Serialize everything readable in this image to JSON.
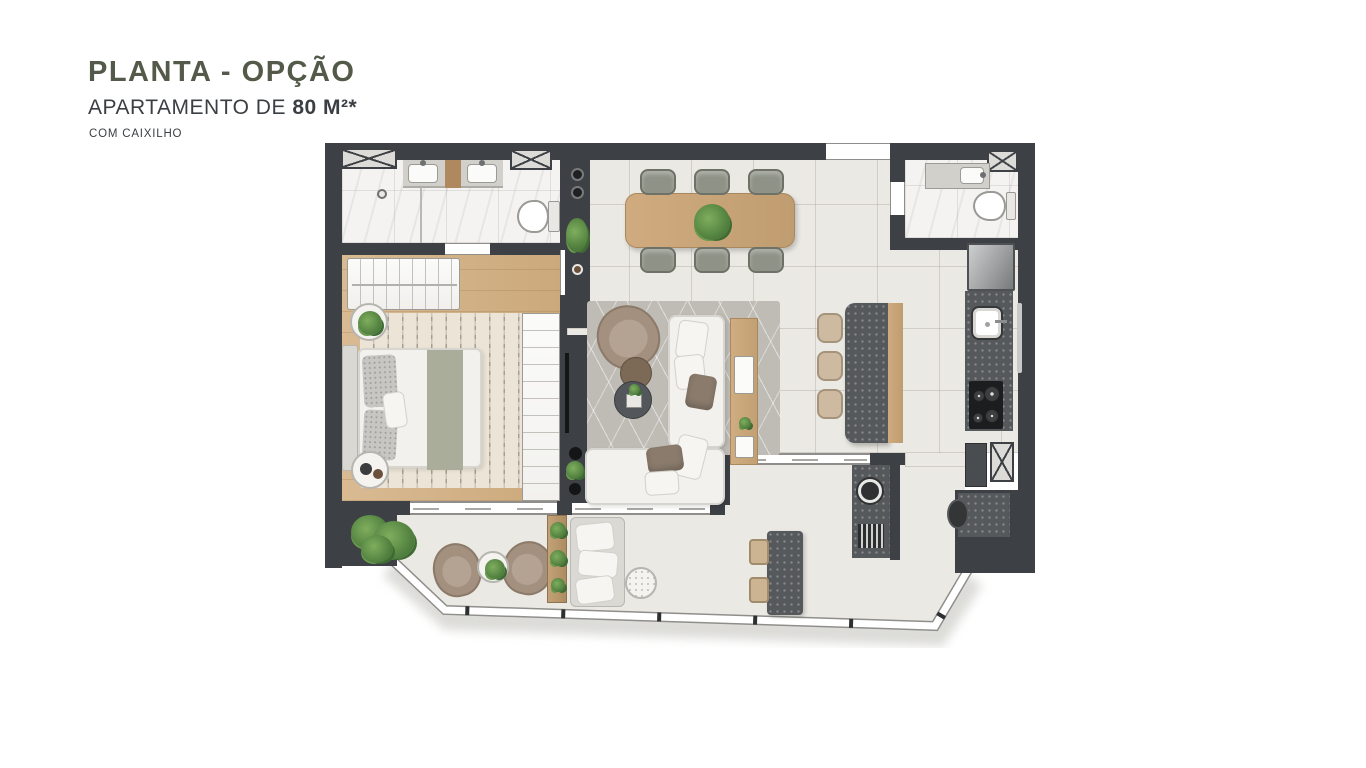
{
  "header": {
    "title": "PLANTA - OPÇÃO",
    "subtitle_prefix": "APARTAMENTO DE ",
    "subtitle_bold": "80 M²*",
    "note": "COM CAIXILHO"
  },
  "colors": {
    "title": "#535a4a",
    "text": "#3b3f43",
    "wall": "#3d4145",
    "tile": "#ebe9e3",
    "marble": "#f4f3f1",
    "wood_floor": "#d3b289",
    "wood": "#c9a87d",
    "stone": "#56595c",
    "rug_living": "#bfbbb5",
    "rug_bedroom": "#ece5d7",
    "sofa": "#f2f1ee",
    "armchair": "#a3907f",
    "plant": "#5d8a48",
    "sage": "#a9ad9a",
    "shadow": "#dedddb"
  }
}
